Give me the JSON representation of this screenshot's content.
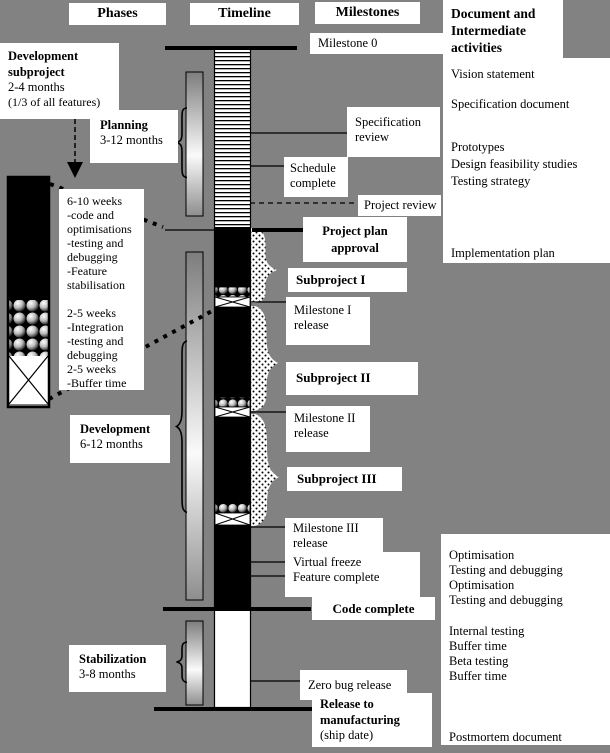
{
  "colors": {
    "background": "#828282",
    "box": "#ffffff",
    "ink": "#000000"
  },
  "headers": {
    "phases": "Phases",
    "timeline": "Timeline",
    "milestones": "Milestones",
    "documents": "Document and Intermediate activities"
  },
  "phase_boxes": {
    "dev_subproject": {
      "title": "Development subproject",
      "duration": "2-4 months",
      "note": "(1/3 of all features)"
    },
    "planning": {
      "title": "Planning",
      "duration": "3-12 months"
    },
    "development": {
      "title": "Development",
      "duration": "6-12 months"
    },
    "stabilization": {
      "title": "Stabilization",
      "duration": "3-8 months"
    }
  },
  "subproject_detail": {
    "lines": [
      "6-10 weeks",
      "-code and",
      "optimisations",
      "-testing and",
      "debugging",
      "-Feature",
      "stabilisation",
      "",
      "2-5 weeks",
      "-Integration",
      "-testing and",
      "debugging",
      "2-5 weeks",
      "-Buffer time"
    ]
  },
  "milestones": {
    "milestone0": "Milestone 0",
    "specification_review": "Specification review",
    "schedule_complete": "Schedule complete",
    "project_review": "Project review",
    "project_plan_approval": "Project plan approval",
    "subproject_1": "Subproject I",
    "milestone_1_release": "Milestone I release",
    "subproject_2": "Subproject II",
    "milestone_2_release": "Milestone II release",
    "subproject_3": "Subproject III",
    "milestone_3_release": "Milestone III release",
    "virtual_freeze": "Virtual freeze",
    "feature_complete": "Feature complete",
    "code_complete": "Code complete",
    "zero_bug_release": "Zero bug release",
    "release_to_manufacturing": "Release to manufacturing",
    "ship_date": "(ship date)"
  },
  "documents_top": {
    "items": [
      "Vision statement",
      "Specification document",
      "Prototypes",
      "Design feasibility studies",
      "Testing strategy",
      "Implementation plan"
    ]
  },
  "documents_bottom": {
    "items": [
      "Optimisation",
      "Testing and debugging",
      "Optimisation",
      "Testing and debugging",
      "Internal testing",
      "Buffer time",
      "Beta testing",
      "Buffer time",
      "Postmortem document"
    ]
  }
}
